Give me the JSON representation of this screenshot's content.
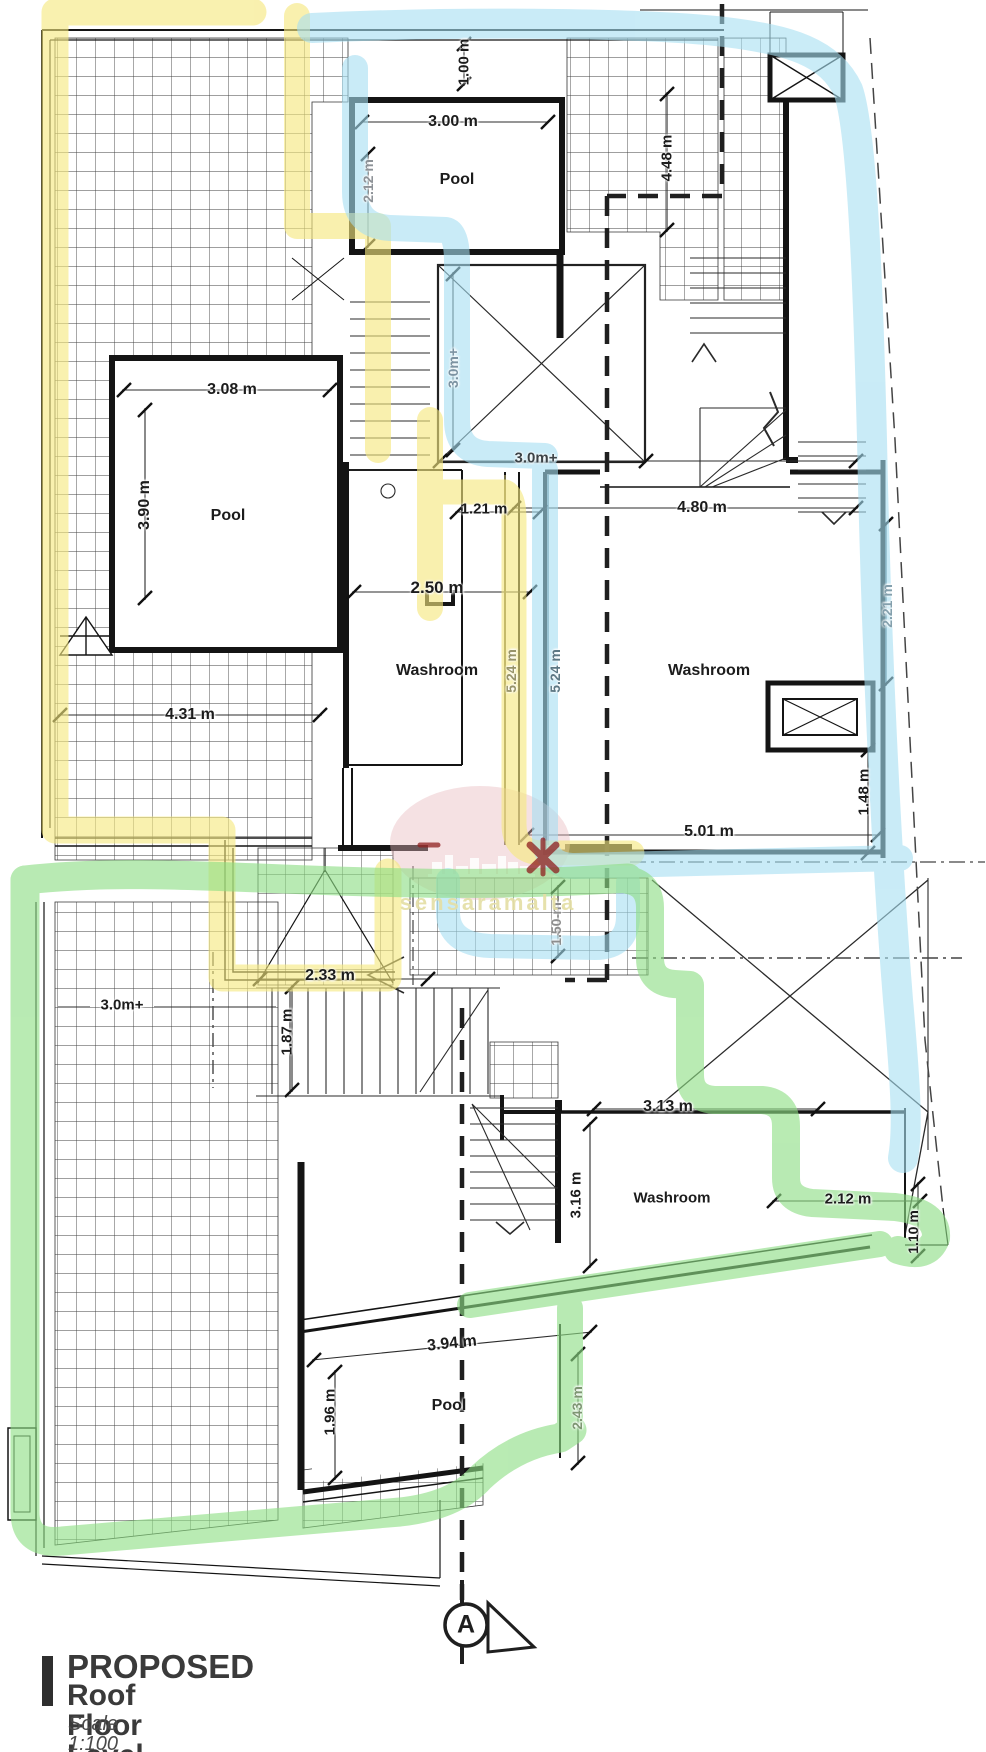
{
  "drawing": {
    "title_line1": "PROPOSED",
    "title_line2": "Roof Floor Level",
    "scale_label": "Scale 1:100",
    "section_marker_label": "A",
    "watermark_text": "sensaramalta"
  },
  "colors": {
    "highlight_yellow": "#f6e87e",
    "highlight_blue": "#a6dff2",
    "highlight_green": "#8ede85",
    "watermark_pink": "#e8b7bd",
    "watermark_red": "#8f1f1f",
    "ink": "#1c1c1c"
  },
  "plan": {
    "room_names": [
      "Pool",
      "Pool",
      "Washroom",
      "Washroom",
      "Washroom",
      "Pool"
    ],
    "labels": [
      {
        "text": "1.00 m",
        "x": 464,
        "y": 62,
        "rot": -90,
        "color": "#1c1c1c",
        "size": 15,
        "kind": "dim"
      },
      {
        "text": "3.00 m",
        "x": 453,
        "y": 122,
        "rot": 0,
        "color": "#1c1c1c",
        "size": 16,
        "kind": "dim"
      },
      {
        "text": "2.12 m",
        "x": 368,
        "y": 181,
        "rot": -90,
        "color": "#8d9297",
        "size": 14,
        "kind": "dim"
      },
      {
        "text": "Pool",
        "x": 457,
        "y": 180,
        "rot": 0,
        "color": "#1c1c1c",
        "size": 16,
        "kind": "room"
      },
      {
        "text": "4.48 m",
        "x": 667,
        "y": 158,
        "rot": -90,
        "color": "#1c1c1c",
        "size": 15,
        "kind": "dim"
      },
      {
        "text": "3.08 m",
        "x": 232,
        "y": 390,
        "rot": 0,
        "color": "#1c1c1c",
        "size": 16,
        "kind": "dim"
      },
      {
        "text": "3.90 m",
        "x": 145,
        "y": 505,
        "rot": -90,
        "color": "#1c1c1c",
        "size": 16,
        "kind": "dim"
      },
      {
        "text": "Pool",
        "x": 228,
        "y": 516,
        "rot": 0,
        "color": "#1c1c1c",
        "size": 16,
        "kind": "room"
      },
      {
        "text": "3.0m+",
        "x": 453,
        "y": 368,
        "rot": -90,
        "color": "#7c93a2",
        "size": 14,
        "kind": "dim"
      },
      {
        "text": "3.0m+",
        "x": 536,
        "y": 458,
        "rot": 0,
        "color": "#3c4347",
        "size": 15,
        "kind": "dim"
      },
      {
        "text": "1.21 m",
        "x": 484,
        "y": 509,
        "rot": 0,
        "color": "#1c1c1c",
        "size": 15,
        "kind": "dim"
      },
      {
        "text": "4.80 m",
        "x": 702,
        "y": 508,
        "rot": 0,
        "color": "#1c1c1c",
        "size": 16,
        "kind": "dim"
      },
      {
        "text": "2.50 m",
        "x": 437,
        "y": 588,
        "rot": 0,
        "color": "#1c1c1c",
        "size": 17,
        "kind": "dim"
      },
      {
        "text": "Washroom",
        "x": 437,
        "y": 671,
        "rot": 0,
        "color": "#1c1c1c",
        "size": 16,
        "kind": "room"
      },
      {
        "text": "5.24 m",
        "x": 511,
        "y": 671,
        "rot": -90,
        "color": "#98946a",
        "size": 14,
        "kind": "dim"
      },
      {
        "text": "5.24 m",
        "x": 555,
        "y": 671,
        "rot": -90,
        "color": "#5d7884",
        "size": 14,
        "kind": "dim"
      },
      {
        "text": "Washroom",
        "x": 709,
        "y": 671,
        "rot": 0,
        "color": "#1c1c1c",
        "size": 16,
        "kind": "room"
      },
      {
        "text": "2.21 m",
        "x": 887,
        "y": 606,
        "rot": -90,
        "color": "#84a0ad",
        "size": 14,
        "kind": "dim"
      },
      {
        "text": "4.31 m",
        "x": 190,
        "y": 715,
        "rot": 0,
        "color": "#1c1c1c",
        "size": 16,
        "kind": "dim"
      },
      {
        "text": "1.48 m",
        "x": 864,
        "y": 792,
        "rot": -90,
        "color": "#1c1c1c",
        "size": 15,
        "kind": "dim"
      },
      {
        "text": "5.01 m",
        "x": 709,
        "y": 832,
        "rot": 0,
        "color": "#1c1c1c",
        "size": 16,
        "kind": "dim"
      },
      {
        "text": "1.50 m",
        "x": 556,
        "y": 924,
        "rot": -90,
        "color": "#8d8d8d",
        "size": 14,
        "kind": "dim"
      },
      {
        "text": "2.33 m",
        "x": 330,
        "y": 976,
        "rot": 0,
        "color": "#1c1c1c",
        "size": 16,
        "kind": "dim"
      },
      {
        "text": "1.87 m",
        "x": 287,
        "y": 1032,
        "rot": -90,
        "color": "#1c1c1c",
        "size": 15,
        "kind": "dim"
      },
      {
        "text": "3.0m+",
        "x": 122,
        "y": 1005,
        "rot": 0,
        "color": "#1c1c1c",
        "size": 15,
        "kind": "dim"
      },
      {
        "text": "3.13 m",
        "x": 668,
        "y": 1107,
        "rot": 0,
        "color": "#1c1c1c",
        "size": 16,
        "kind": "dim"
      },
      {
        "text": "3.16 m",
        "x": 576,
        "y": 1195,
        "rot": -90,
        "color": "#1c1c1c",
        "size": 15,
        "kind": "dim"
      },
      {
        "text": "Washroom",
        "x": 672,
        "y": 1198,
        "rot": 0,
        "color": "#1c1c1c",
        "size": 15,
        "kind": "room"
      },
      {
        "text": "2.12 m",
        "x": 848,
        "y": 1199,
        "rot": 0,
        "color": "#1c1c1c",
        "size": 15,
        "kind": "dim"
      },
      {
        "text": "1.10 m",
        "x": 913,
        "y": 1232,
        "rot": -90,
        "color": "#1c1c1c",
        "size": 14,
        "kind": "dim"
      },
      {
        "text": "3.94 m",
        "x": 452,
        "y": 1344,
        "rot": -6,
        "color": "#1c1c1c",
        "size": 16,
        "kind": "dim"
      },
      {
        "text": "Pool",
        "x": 449,
        "y": 1406,
        "rot": 0,
        "color": "#1c1c1c",
        "size": 16,
        "kind": "room"
      },
      {
        "text": "1.96 m",
        "x": 330,
        "y": 1412,
        "rot": -90,
        "color": "#1c1c1c",
        "size": 15,
        "kind": "dim"
      },
      {
        "text": "2.43 m",
        "x": 577,
        "y": 1408,
        "rot": -90,
        "color": "#7e9673",
        "size": 14,
        "kind": "dim"
      }
    ]
  }
}
